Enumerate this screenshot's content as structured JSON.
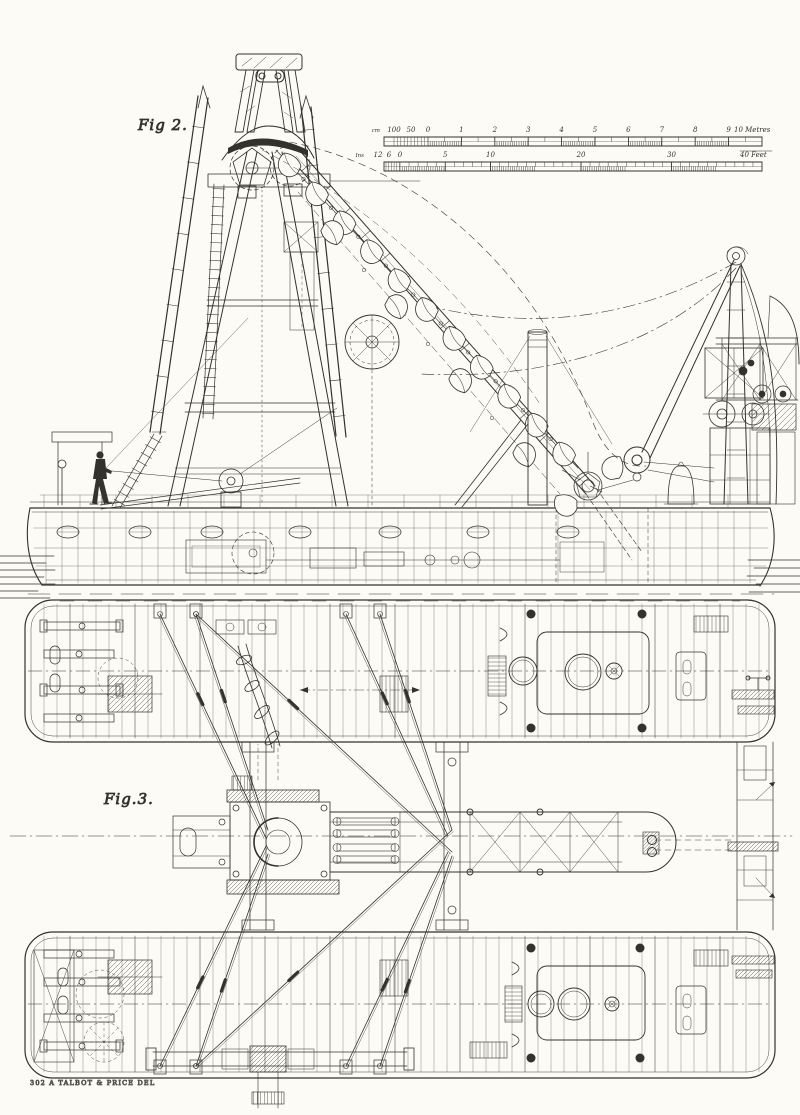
{
  "figures": {
    "fig2": "Fig 2.",
    "fig3": "Fig.3."
  },
  "scales": {
    "metric": {
      "prefix": "cm",
      "pre_zero": [
        "100",
        "50",
        "0"
      ],
      "majors": [
        "1",
        "2",
        "3",
        "4",
        "5",
        "6",
        "7",
        "8",
        "9"
      ],
      "end": "10 Metres"
    },
    "imperial": {
      "prefix": "Ins",
      "pre_zero": [
        "12",
        "6",
        "0"
      ],
      "majors": [
        "5",
        "10",
        "20",
        "30"
      ],
      "end": "40 Feet"
    }
  },
  "credit": "302 A TALBOT & PRICE DEL",
  "colors": {
    "ink": "#34322c",
    "ink_light": "#6b6860",
    "paper": "#fcfbf6"
  }
}
